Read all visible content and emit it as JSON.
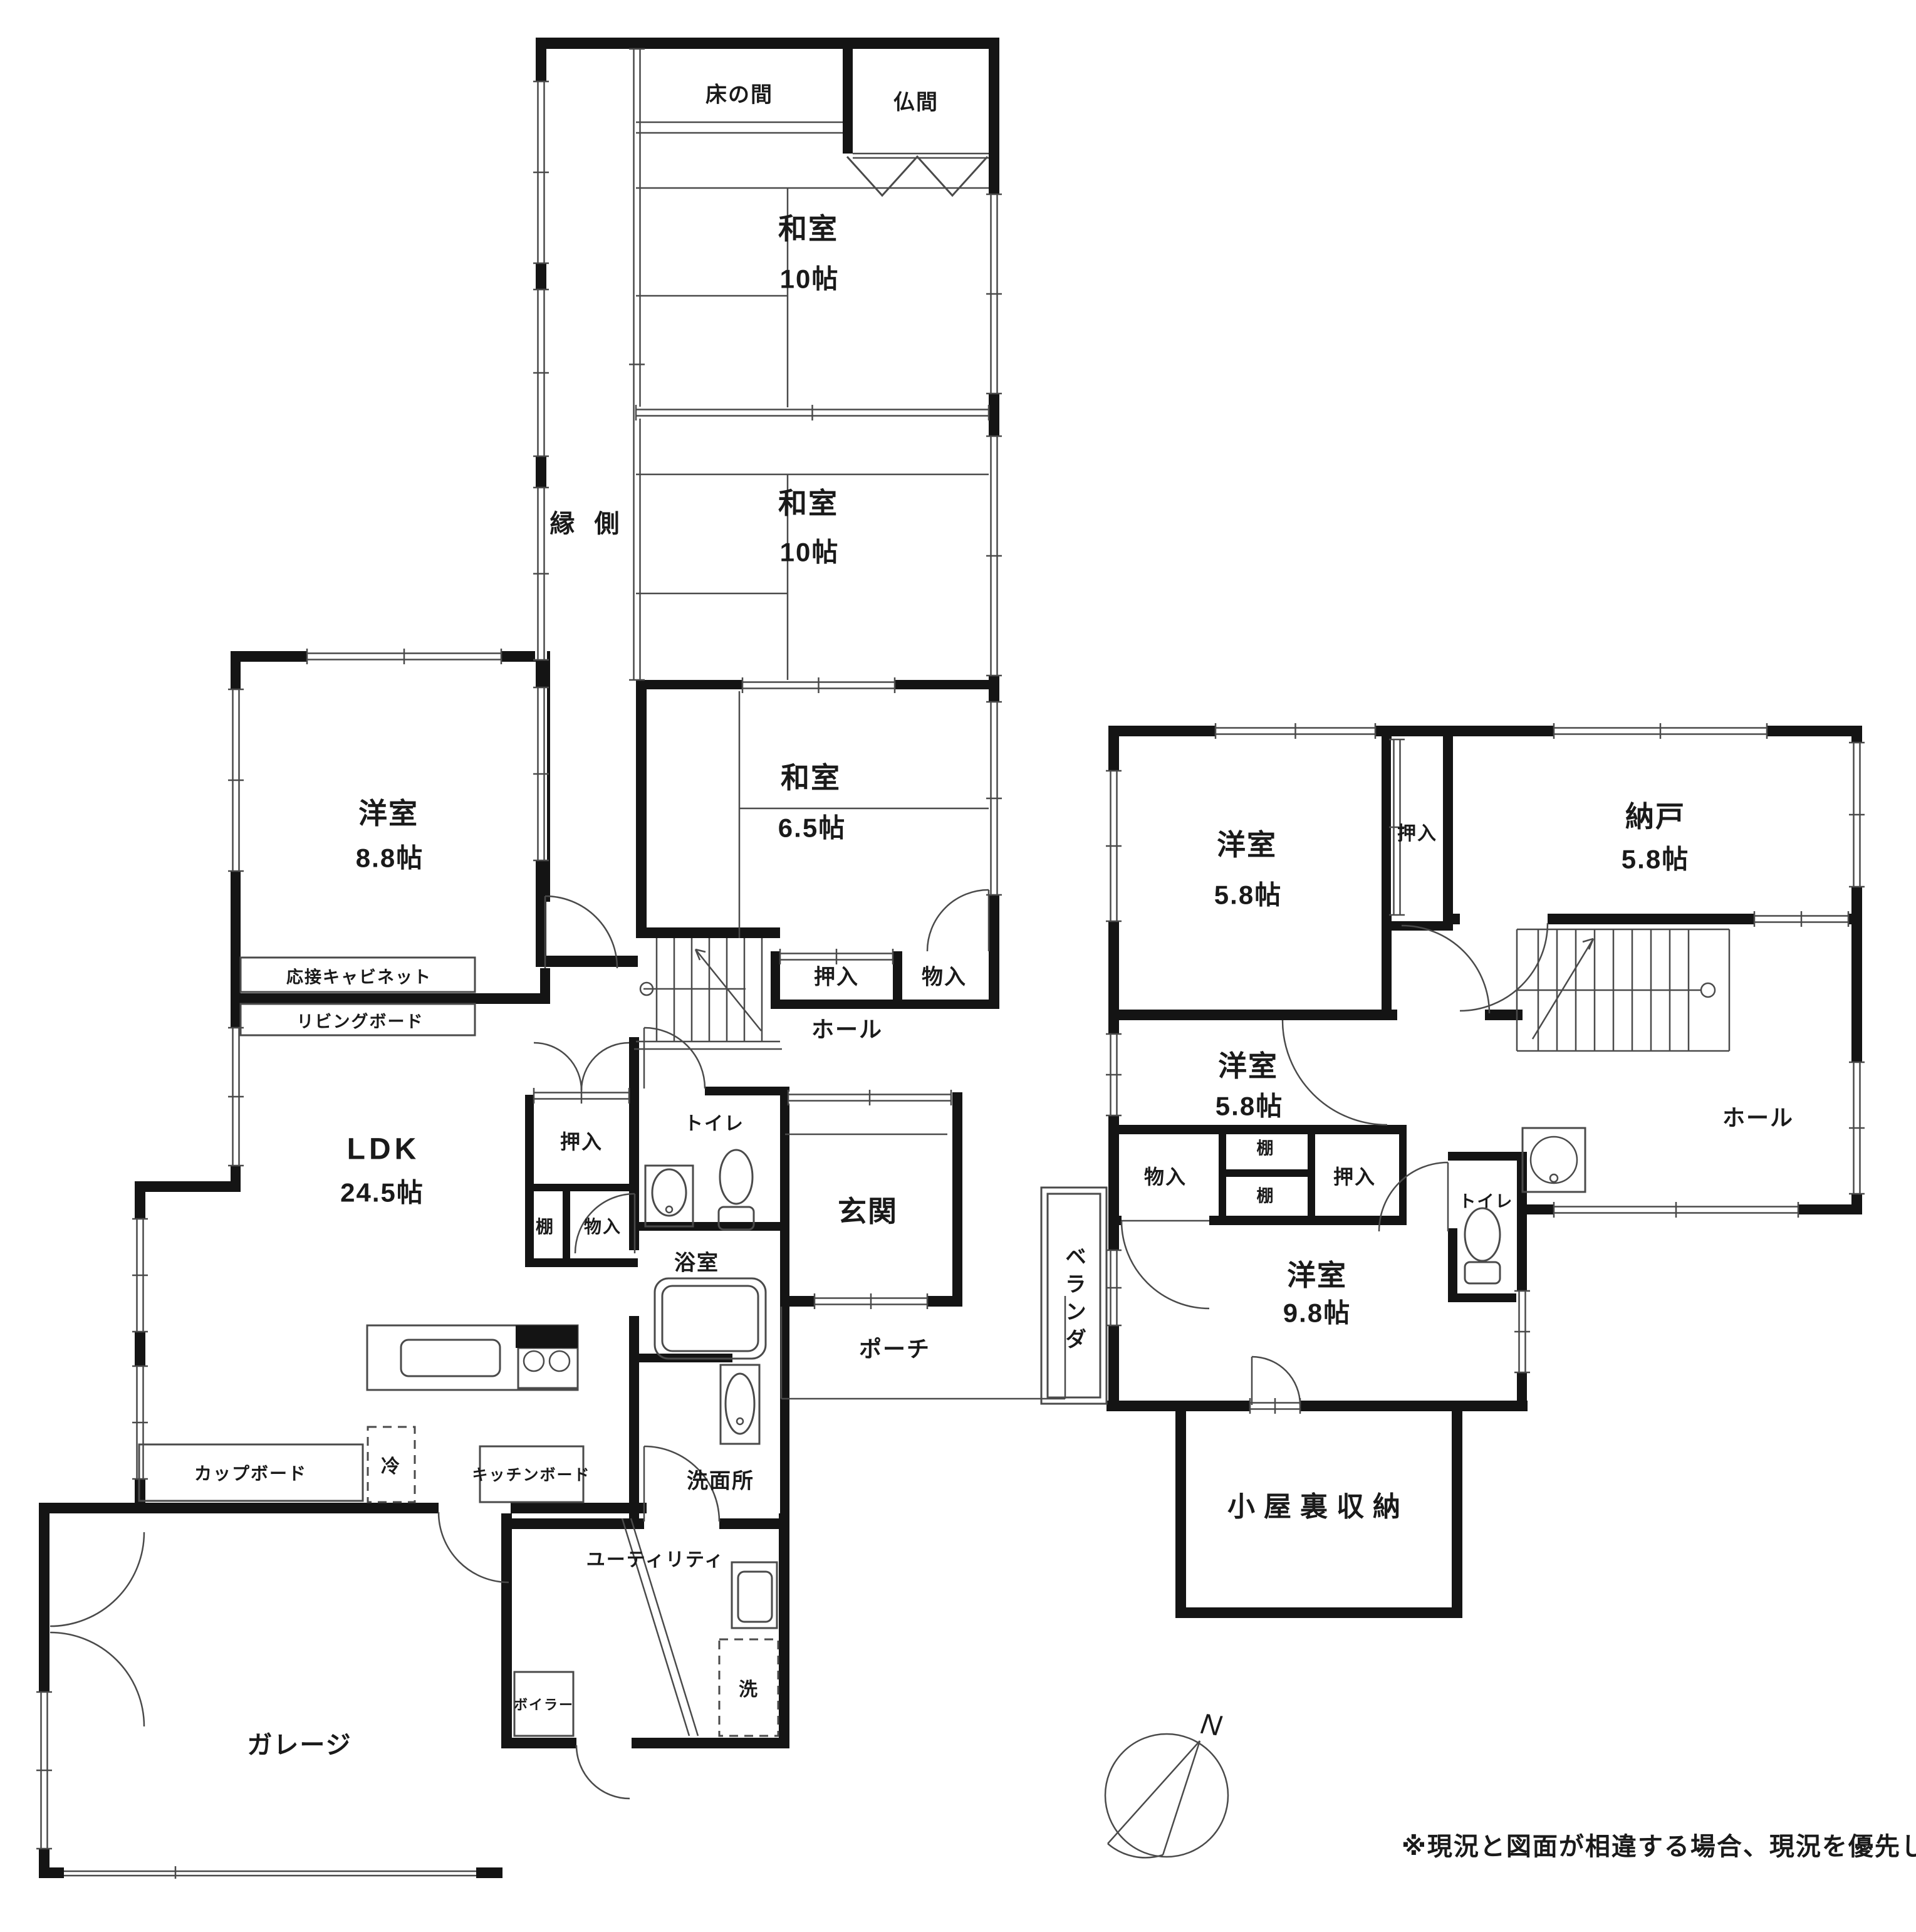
{
  "floor1": {
    "tokonoma": "床の間",
    "butsuma": "仏間",
    "washitsu_a": {
      "name": "和室",
      "size": "10帖"
    },
    "engawa": "縁 側",
    "washitsu_b": {
      "name": "和室",
      "size": "10帖"
    },
    "washitsu_c": {
      "name": "和室",
      "size": "6.5帖"
    },
    "oshiire_band": "押入",
    "monoire_band": "物入",
    "yoshitsu88": {
      "name": "洋室",
      "size": "8.8帖"
    },
    "cabinet": "応接キャビネット",
    "livingboard": "リビングボード",
    "ldk": {
      "name": "LDK",
      "size": "24.5帖"
    },
    "hall": "ホール",
    "oshiire": "押入",
    "tana": "棚",
    "monoire": "物入",
    "toilet": "トイレ",
    "genkan": "玄関",
    "bath": "浴室",
    "porch": "ポーチ",
    "senmenjo": "洗面所",
    "cupboard": "カップボード",
    "refrigerator": "冷",
    "kitchenboard": "キッチンボード",
    "utility": "ユーティリティ",
    "boiler": "ボイラー",
    "laundry": "洗",
    "garage": "ガレージ"
  },
  "floor2": {
    "yoshitsu_top": {
      "name": "洋室",
      "size": "5.8帖"
    },
    "oshiire_top": "押入",
    "nando": {
      "name": "納戸",
      "size": "5.8帖"
    },
    "hall": "ホール",
    "yoshitsu_mid": {
      "name": "洋室",
      "size": "5.8帖"
    },
    "toilet": "トイレ",
    "monoire": "物入",
    "tana_upper": "棚",
    "tana_lower": "棚",
    "oshiire_mid": "押入",
    "veranda": "ベランダ",
    "yoshitsu98": {
      "name": "洋室",
      "size": "9.8帖"
    },
    "attic": "小屋裏収納"
  },
  "compass": {
    "north": "N"
  },
  "disclaimer": "※現況と図面が相違する場合、現況を優先します",
  "colors": {
    "wall": "#141414",
    "line": "#4a4a4a",
    "text": "#141414",
    "bg": "#ffffff"
  }
}
